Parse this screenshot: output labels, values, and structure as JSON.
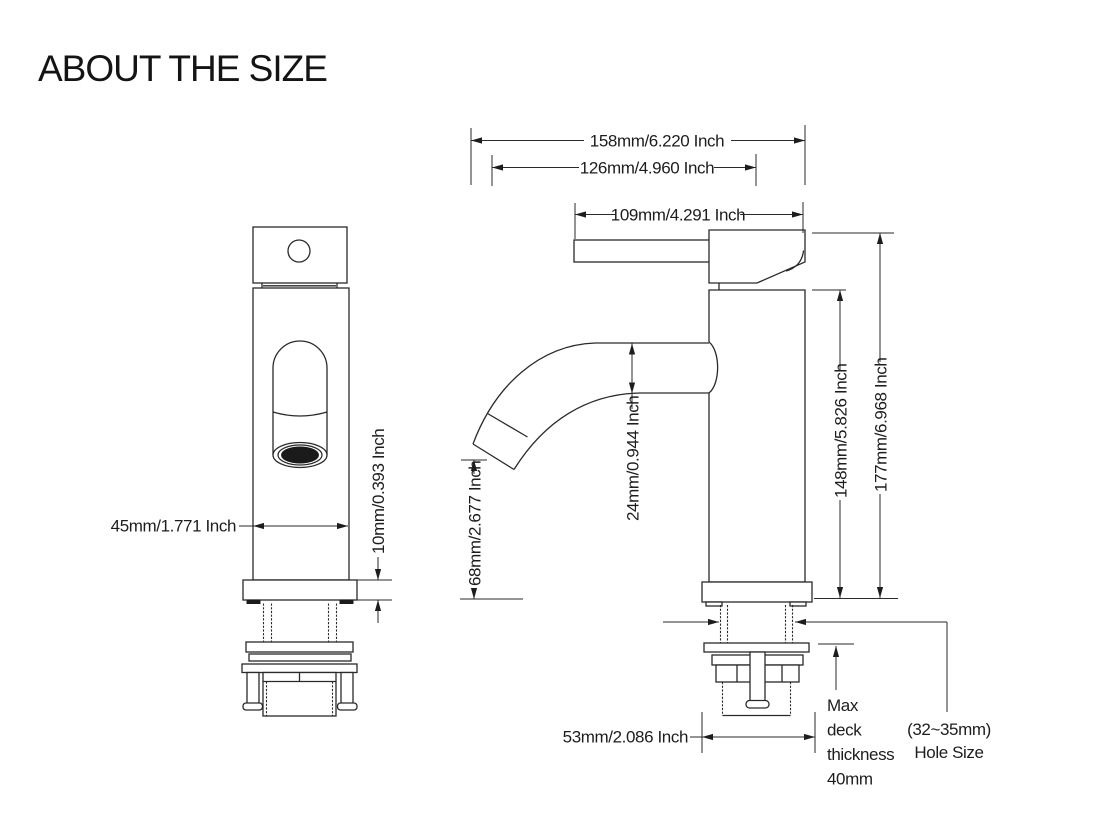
{
  "title": "ABOUT THE SIZE",
  "dims": {
    "overall_width": "158mm/6.220 Inch",
    "spout_reach": "126mm/4.960 Inch",
    "handle_length": "109mm/4.291 Inch",
    "body_width": "45mm/1.771 Inch",
    "base_height": "10mm/0.393 Inch",
    "spout_clearance": "68mm/2.677 Inch",
    "spout_diameter": "24mm/0.944 Inch",
    "body_height": "148mm/5.826 Inch",
    "overall_height": "177mm/6.968 Inch",
    "base_width": "53mm/2.086 Inch"
  },
  "notes": {
    "deck_thickness": [
      "Max",
      "deck",
      "thickness",
      "40mm"
    ],
    "hole_size": [
      "(32~35mm)",
      "Hole Size"
    ]
  }
}
